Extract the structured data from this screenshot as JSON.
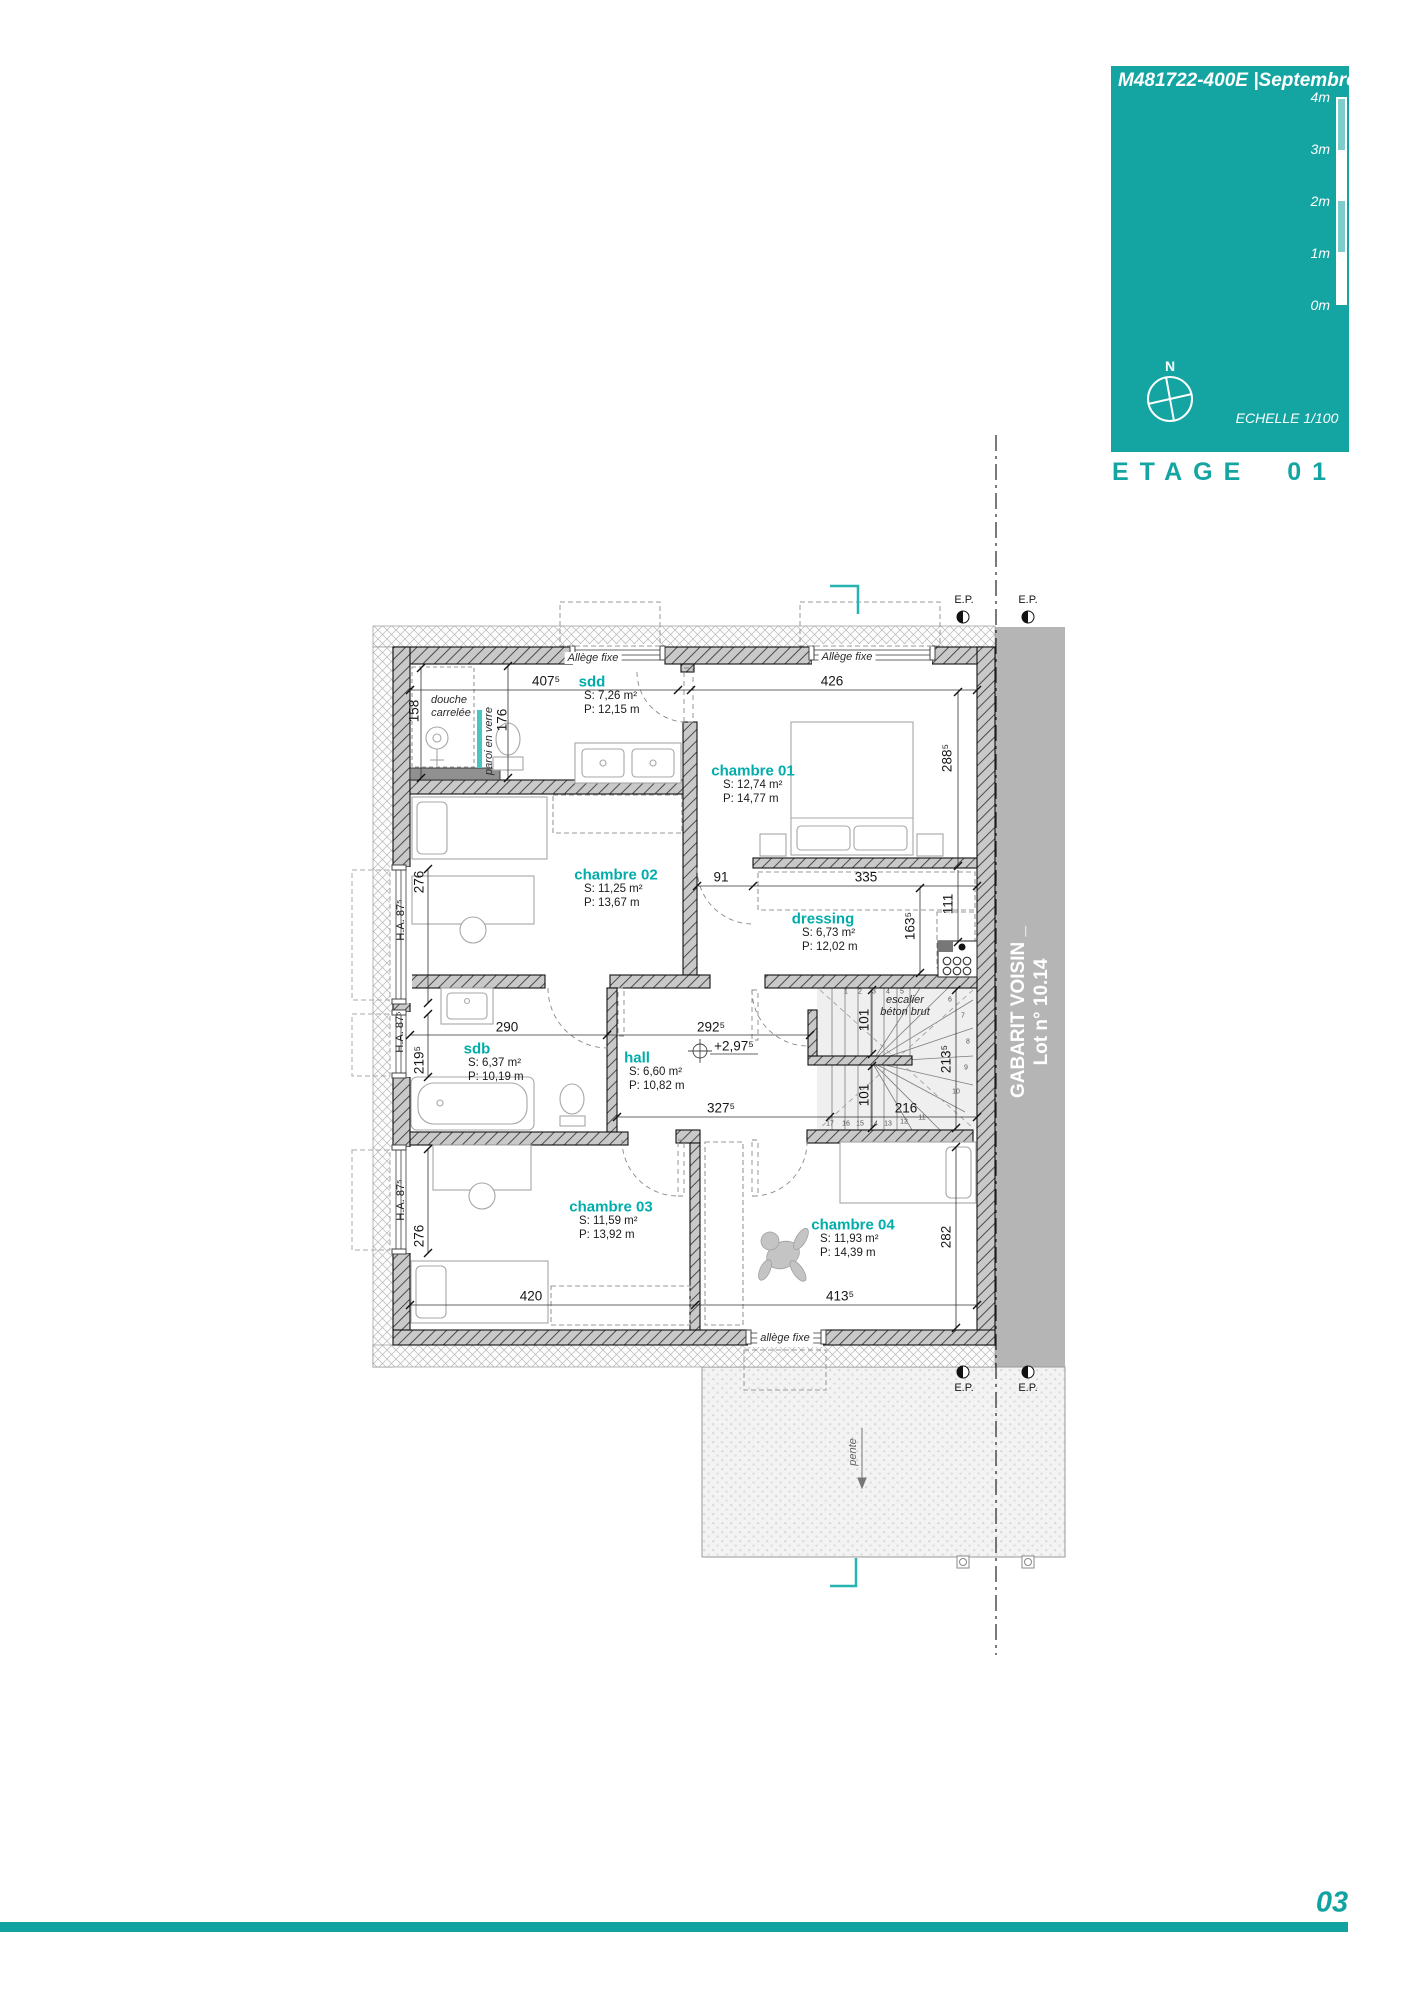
{
  "header": {
    "title": "M481722-400E |Septembre 2024",
    "floor_title": "ETAGE 01",
    "scale_text": "ECHELLE 1/100",
    "north_label": "N",
    "scale_ticks": [
      "4m",
      "3m",
      "2m",
      "1m",
      "0m"
    ]
  },
  "footer": {
    "page_number": "03"
  },
  "neighbor": {
    "line1": "GABARIT VOISIN _",
    "line2": "Lot n° 10.14"
  },
  "rooms": [
    {
      "name": "sdd",
      "area": "S: 7,26 m²",
      "perimeter": "P: 12,15 m"
    },
    {
      "name": "chambre 01",
      "area": "S: 12,74 m²",
      "perimeter": "P: 14,77 m"
    },
    {
      "name": "chambre 02",
      "area": "S: 11,25 m²",
      "perimeter": "P: 13,67 m"
    },
    {
      "name": "dressing",
      "area": "S: 6,73 m²",
      "perimeter": "P: 12,02 m"
    },
    {
      "name": "sdb",
      "area": "S: 6,37 m²",
      "perimeter": "P: 10,19 m"
    },
    {
      "name": "hall",
      "area": "S: 6,60 m²",
      "perimeter": "P: 10,82 m"
    },
    {
      "name": "chambre 03",
      "area": "S: 11,59 m²",
      "perimeter": "P: 13,92 m"
    },
    {
      "name": "chambre 04",
      "area": "S: 11,93 m²",
      "perimeter": "P: 14,39 m"
    }
  ],
  "dims": {
    "sdd_width": "407⁵",
    "ch01_width": "426",
    "ch01_height": "288⁵",
    "shower": "158",
    "sdd_depth": "176",
    "door_gap": "91",
    "dressing_width": "335",
    "dressing_h1": "111",
    "dressing_h2": "163⁵",
    "win_ch02": "276",
    "ha_ch02": "H.A. 87⁵",
    "sdb_width": "290",
    "hall_width": "292⁵",
    "level": "+2,97⁵",
    "ha_sdb": "H.A. 87⁵",
    "win_sdb": "219⁵",
    "hall_width2": "327⁵",
    "stair_up": "101",
    "stair_down": "101",
    "stair_turn": "213⁵",
    "stair_width": "216",
    "ha_ch03": "H.A. 87⁵",
    "win_ch03": "276",
    "ch03_width": "420",
    "ch04_width": "413⁵",
    "ch04_height": "282"
  },
  "annotations": {
    "allege_fixe_cap": "Allège fixe",
    "allege_fixe_low": "allège fixe",
    "douche_l1": "douche",
    "douche_l2": "carrelée",
    "paroi": "paroi en verre",
    "escalier_l1": "escalier",
    "escalier_l2": "béton brut",
    "pente": "pente",
    "ep": "E.P."
  },
  "stairs": {
    "treads": [
      "1",
      "2",
      "3",
      "4",
      "5",
      "6",
      "7",
      "8",
      "9",
      "10",
      "11",
      "12",
      "13",
      "14",
      "15",
      "16",
      "17"
    ]
  },
  "colors": {
    "teal": "#14a5a3",
    "room_label": "#00adab",
    "neighbor_band": "#b5b5b5"
  }
}
